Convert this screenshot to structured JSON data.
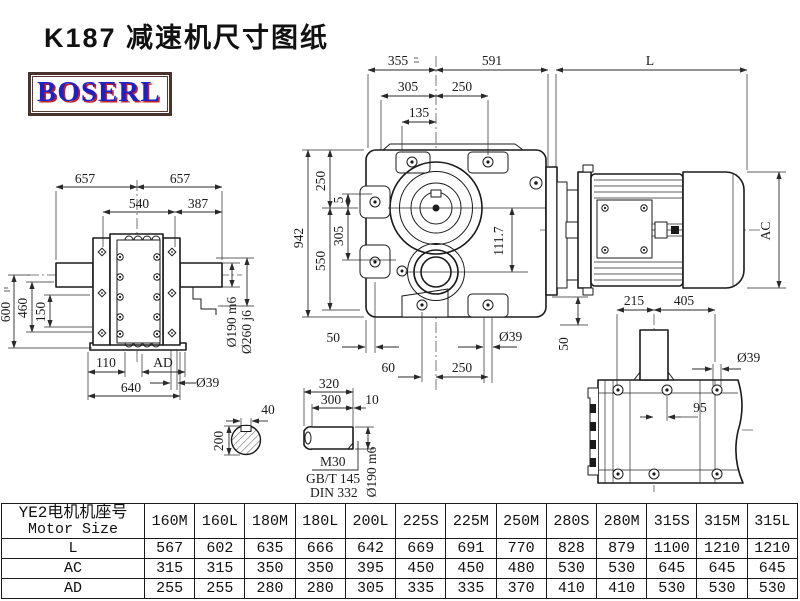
{
  "title": "K187 减速机尺寸图纸",
  "logo": "BOSERL",
  "dims": {
    "d355": "355",
    "d591": "591",
    "dL": "L",
    "d305t": "305",
    "d250t": "250",
    "d135": "135",
    "d942": "942",
    "d250l": "250",
    "d550": "550",
    "d5": "5",
    "d305l": "305",
    "d50bl": "50",
    "dia39f": "Ø39",
    "d60": "60",
    "d250b": "250",
    "d111_7": "111.7",
    "d50r": "50",
    "dAC": "AC",
    "d215": "215",
    "d405": "405",
    "dia39t": "Ø39",
    "d95": "95",
    "d657a": "657",
    "d657b": "657",
    "d540": "540",
    "d387": "387",
    "d600": "600",
    "d460": "460",
    "d150": "150",
    "d110": "110",
    "dADlv": "AD",
    "d640": "640",
    "dia39l": "Ø39",
    "dia190l": "Ø190 m6",
    "dia260": "Ø260 j6",
    "d320": "320",
    "d300": "300",
    "d10": "10",
    "M30": "M30",
    "gbt": "GB/T 145",
    "din": "DIN 332",
    "dia190s": "Ø190 m6",
    "d40": "40",
    "d200": "200"
  },
  "table": {
    "header": {
      "cn": "YE2电机机座号",
      "en": "Motor Size"
    },
    "columns": [
      "160M",
      "160L",
      "180M",
      "180L",
      "200L",
      "225S",
      "225M",
      "250M",
      "280S",
      "280M",
      "315S",
      "315M",
      "315L"
    ],
    "rows": [
      {
        "label": "L",
        "values": [
          "567",
          "602",
          "635",
          "666",
          "642",
          "669",
          "691",
          "770",
          "828",
          "879",
          "1100",
          "1210",
          "1210"
        ]
      },
      {
        "label": "AC",
        "values": [
          "315",
          "315",
          "350",
          "350",
          "395",
          "450",
          "450",
          "480",
          "530",
          "530",
          "645",
          "645",
          "645"
        ]
      },
      {
        "label": "AD",
        "values": [
          "255",
          "255",
          "280",
          "280",
          "305",
          "335",
          "335",
          "370",
          "410",
          "410",
          "530",
          "530",
          "530"
        ]
      }
    ]
  }
}
